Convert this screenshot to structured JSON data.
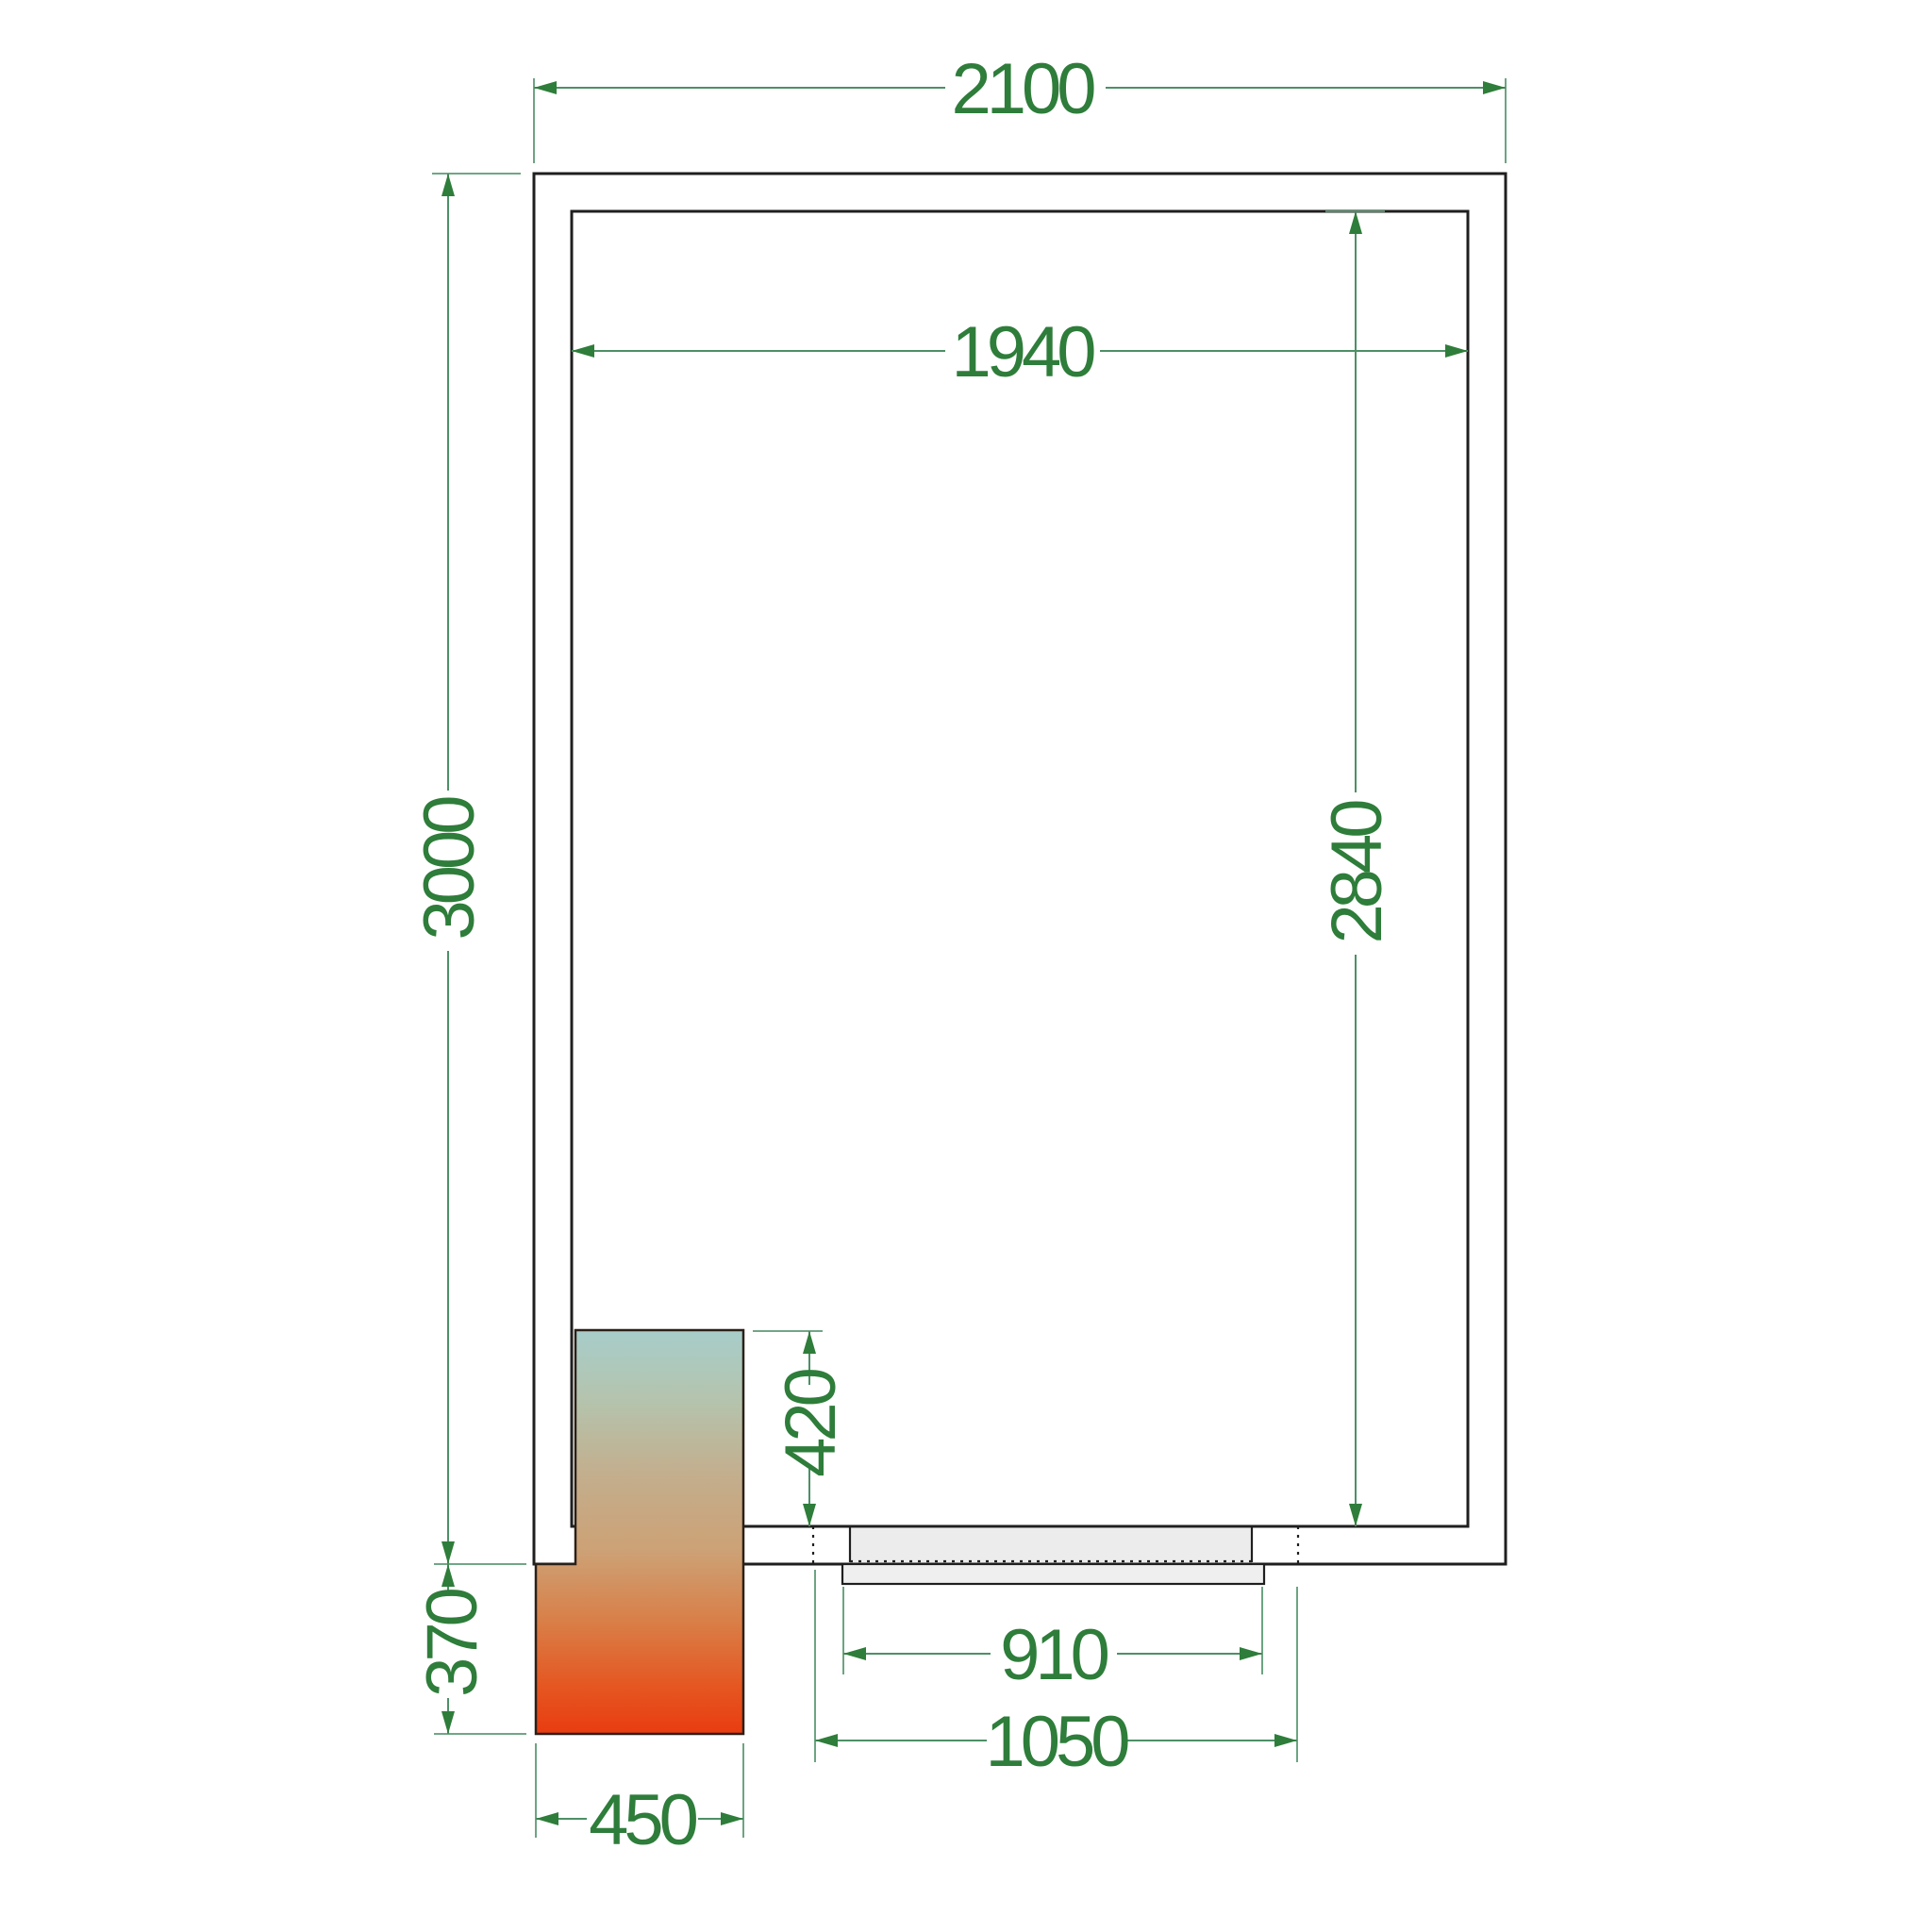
{
  "drawing": {
    "type": "cold-room floor plan technical drawing",
    "elements": {
      "room": "insulated room with double wall outline",
      "cooling_unit": "refrigeration unit block with thermal gradient",
      "door": "sliding door in bottom wall"
    }
  },
  "dims": {
    "outer_width": {
      "label": "2100"
    },
    "inner_width": {
      "label": "1940"
    },
    "outer_height": {
      "label": "3000"
    },
    "inner_height": {
      "label": "2840"
    },
    "unit_inset": {
      "label": "420"
    },
    "unit_below": {
      "label": "370"
    },
    "unit_width": {
      "label": "450"
    },
    "door_leaf": {
      "label": "910"
    },
    "door_opening": {
      "label": "1050"
    }
  },
  "colors": {
    "dimension_text": "#2e7d3a",
    "dimension_line": "#4d9066",
    "wall_line": "#1f1f1f",
    "door_fill": "#ececec",
    "door_leaf_fill": "#efefef",
    "unit_gradient": [
      "#a7cdca",
      "#b5c3ac",
      "#c3ae8d",
      "#cda175",
      "#d97f48",
      "#e55722",
      "#e93c10"
    ]
  }
}
